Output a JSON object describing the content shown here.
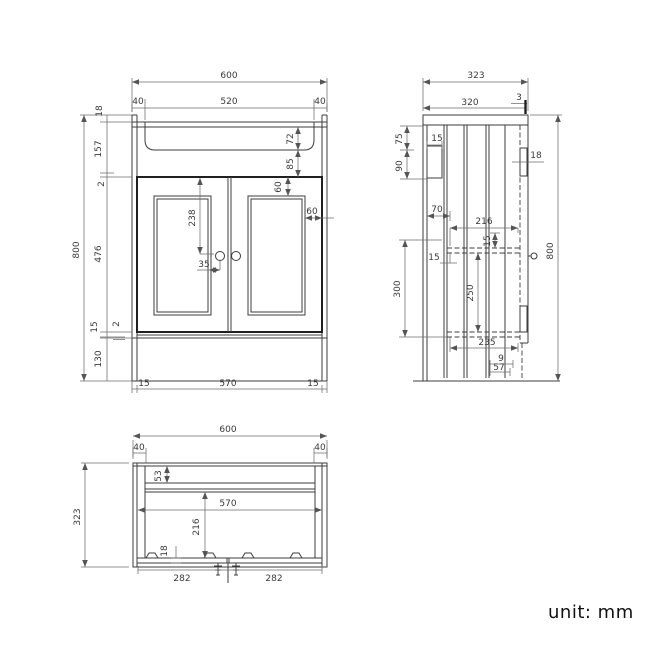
{
  "front_view": {
    "overall_width": "600",
    "overhang_left": "40",
    "basin_width": "520",
    "overhang_right": "40",
    "top_thickness": "18",
    "apron_height": "157",
    "top_gap": "2",
    "door_height": "476",
    "bottom_rail": "15",
    "bottom_gap": "2",
    "plinth_height": "130",
    "overall_height": "800",
    "basin_depth": "72",
    "basin_to_door": "85",
    "panel_inset_top": "60",
    "panel_inset_side": "60",
    "handle_drop": "238",
    "handle_offset": "35",
    "side_left": "15",
    "internal_width": "570",
    "side_right": "15"
  },
  "side_view": {
    "overall_depth": "323",
    "top_depth": "320",
    "back_lip": "3",
    "bracket_top": "75",
    "bracket_width": "15",
    "bracket_height": "90",
    "front_offset": "70",
    "shelf_gap": "15",
    "shelf_drop": "300",
    "shelf_depth": "216",
    "shelf_thickness": "15",
    "lower_height": "250",
    "bottom_depth": "235",
    "plinth_lip": "9",
    "plinth_depth": "57",
    "door_thickness": "18",
    "overall_height": "800"
  },
  "plan_view": {
    "overall_width": "600",
    "post_left": "40",
    "post_right": "40",
    "overall_depth": "323",
    "back_rail": "53",
    "internal_width": "570",
    "internal_depth": "216",
    "door_thickness": "18",
    "door_left": "282",
    "door_right": "282"
  },
  "footer": {
    "unit_label": "unit: mm"
  }
}
